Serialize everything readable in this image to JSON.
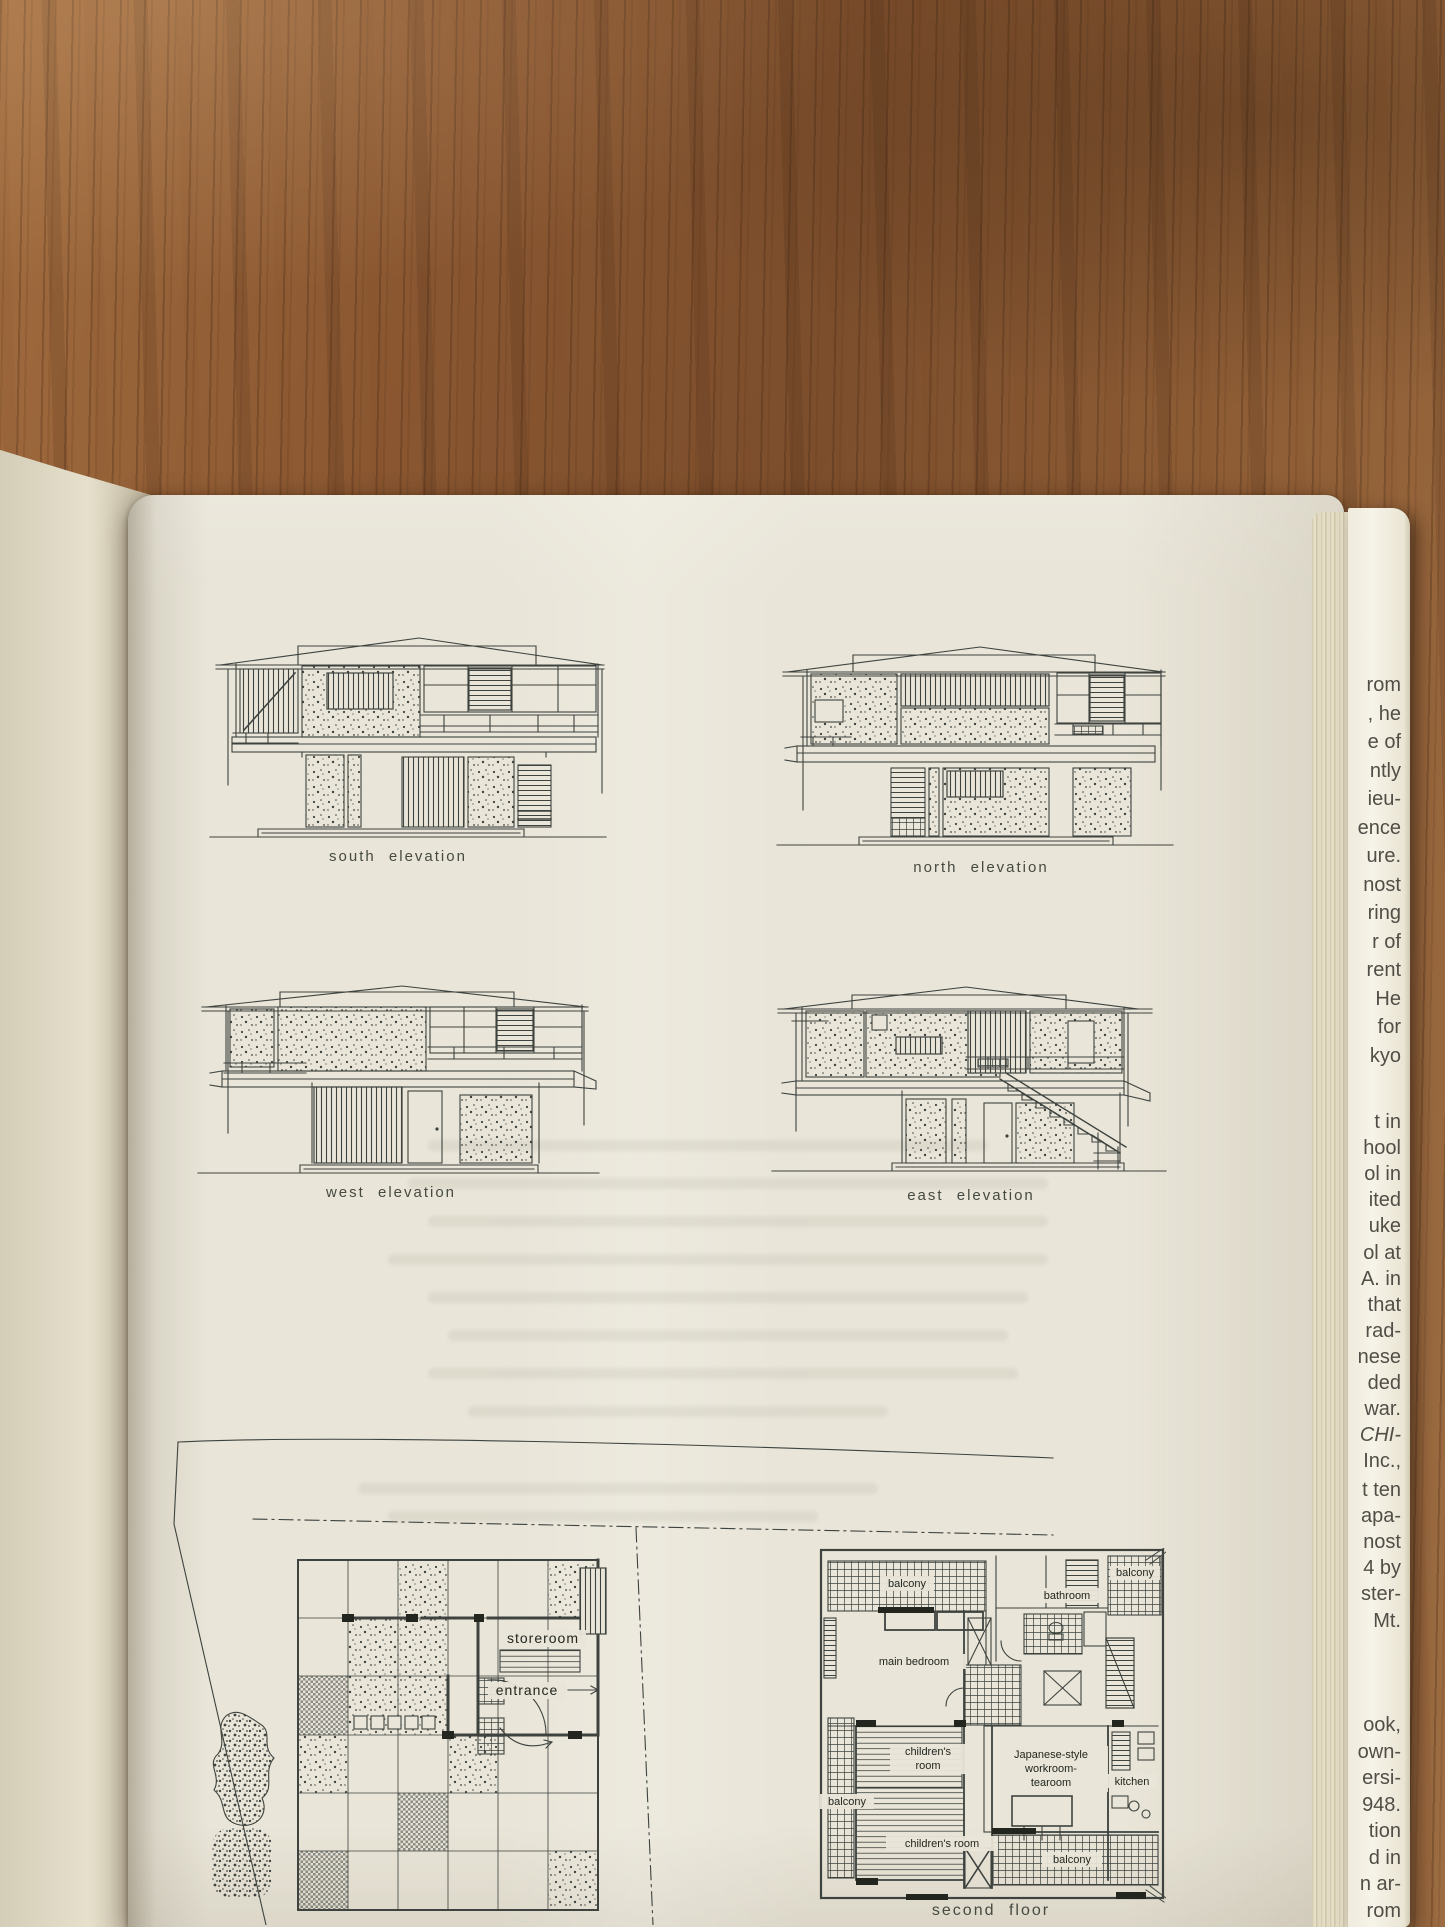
{
  "book_page": {
    "elevations": {
      "south": "south elevation",
      "north": "north elevation",
      "west": "west elevation",
      "east": "east elevation"
    },
    "first_floor_plan": {
      "storeroom": "storeroom",
      "entrance": "entrance"
    },
    "second_floor_plan": {
      "caption": "second floor",
      "balcony_top": "balcony",
      "bathroom": "bathroom",
      "balcony_top_right": "balcony",
      "main_bedroom": "main bedroom",
      "childrens_upper_line1": "children's",
      "childrens_upper_line2": "room",
      "workroom_line1": "Japanese-style",
      "workroom_line2": "workroom-",
      "workroom_line3": "tearoom",
      "kitchen": "kitchen",
      "balcony_left": "balcony",
      "childrens_lower": "children's room",
      "balcony_bottom": "balcony"
    }
  },
  "fore_edge_text": {
    "groups": [
      {
        "start_y": 688,
        "line_height": 28.5,
        "lines": [
          "rom",
          ", he",
          "e of",
          "ntly",
          "ieu-",
          "ence",
          "ure.",
          "nost",
          "ring",
          "r of",
          "rent",
          "He",
          "for",
          "kyo"
        ]
      },
      {
        "start_y": 1125,
        "line_height": 26.1,
        "lines": [
          "t in",
          "hool",
          "ol in",
          "ited",
          "uke",
          "ol at",
          "A. in",
          "that",
          "rad-",
          "nese",
          "ded",
          "war.",
          "CHI-",
          "Inc.,"
        ],
        "italic": [
          "CHI-"
        ]
      },
      {
        "start_y": 1493,
        "line_height": 26.1,
        "lines": [
          "t ten",
          "apa-",
          "nost",
          "4 by",
          "ster-",
          "Mt."
        ]
      },
      {
        "start_y": 1728,
        "line_height": 26.5,
        "lines": [
          "ook,",
          "own-",
          "ersi-",
          "948.",
          "tion",
          "d in",
          "n ar-",
          "rom"
        ]
      }
    ]
  },
  "colors": {
    "paper": "#e9e5d8",
    "ink": "#3e433f",
    "wood": "#8a5731"
  }
}
